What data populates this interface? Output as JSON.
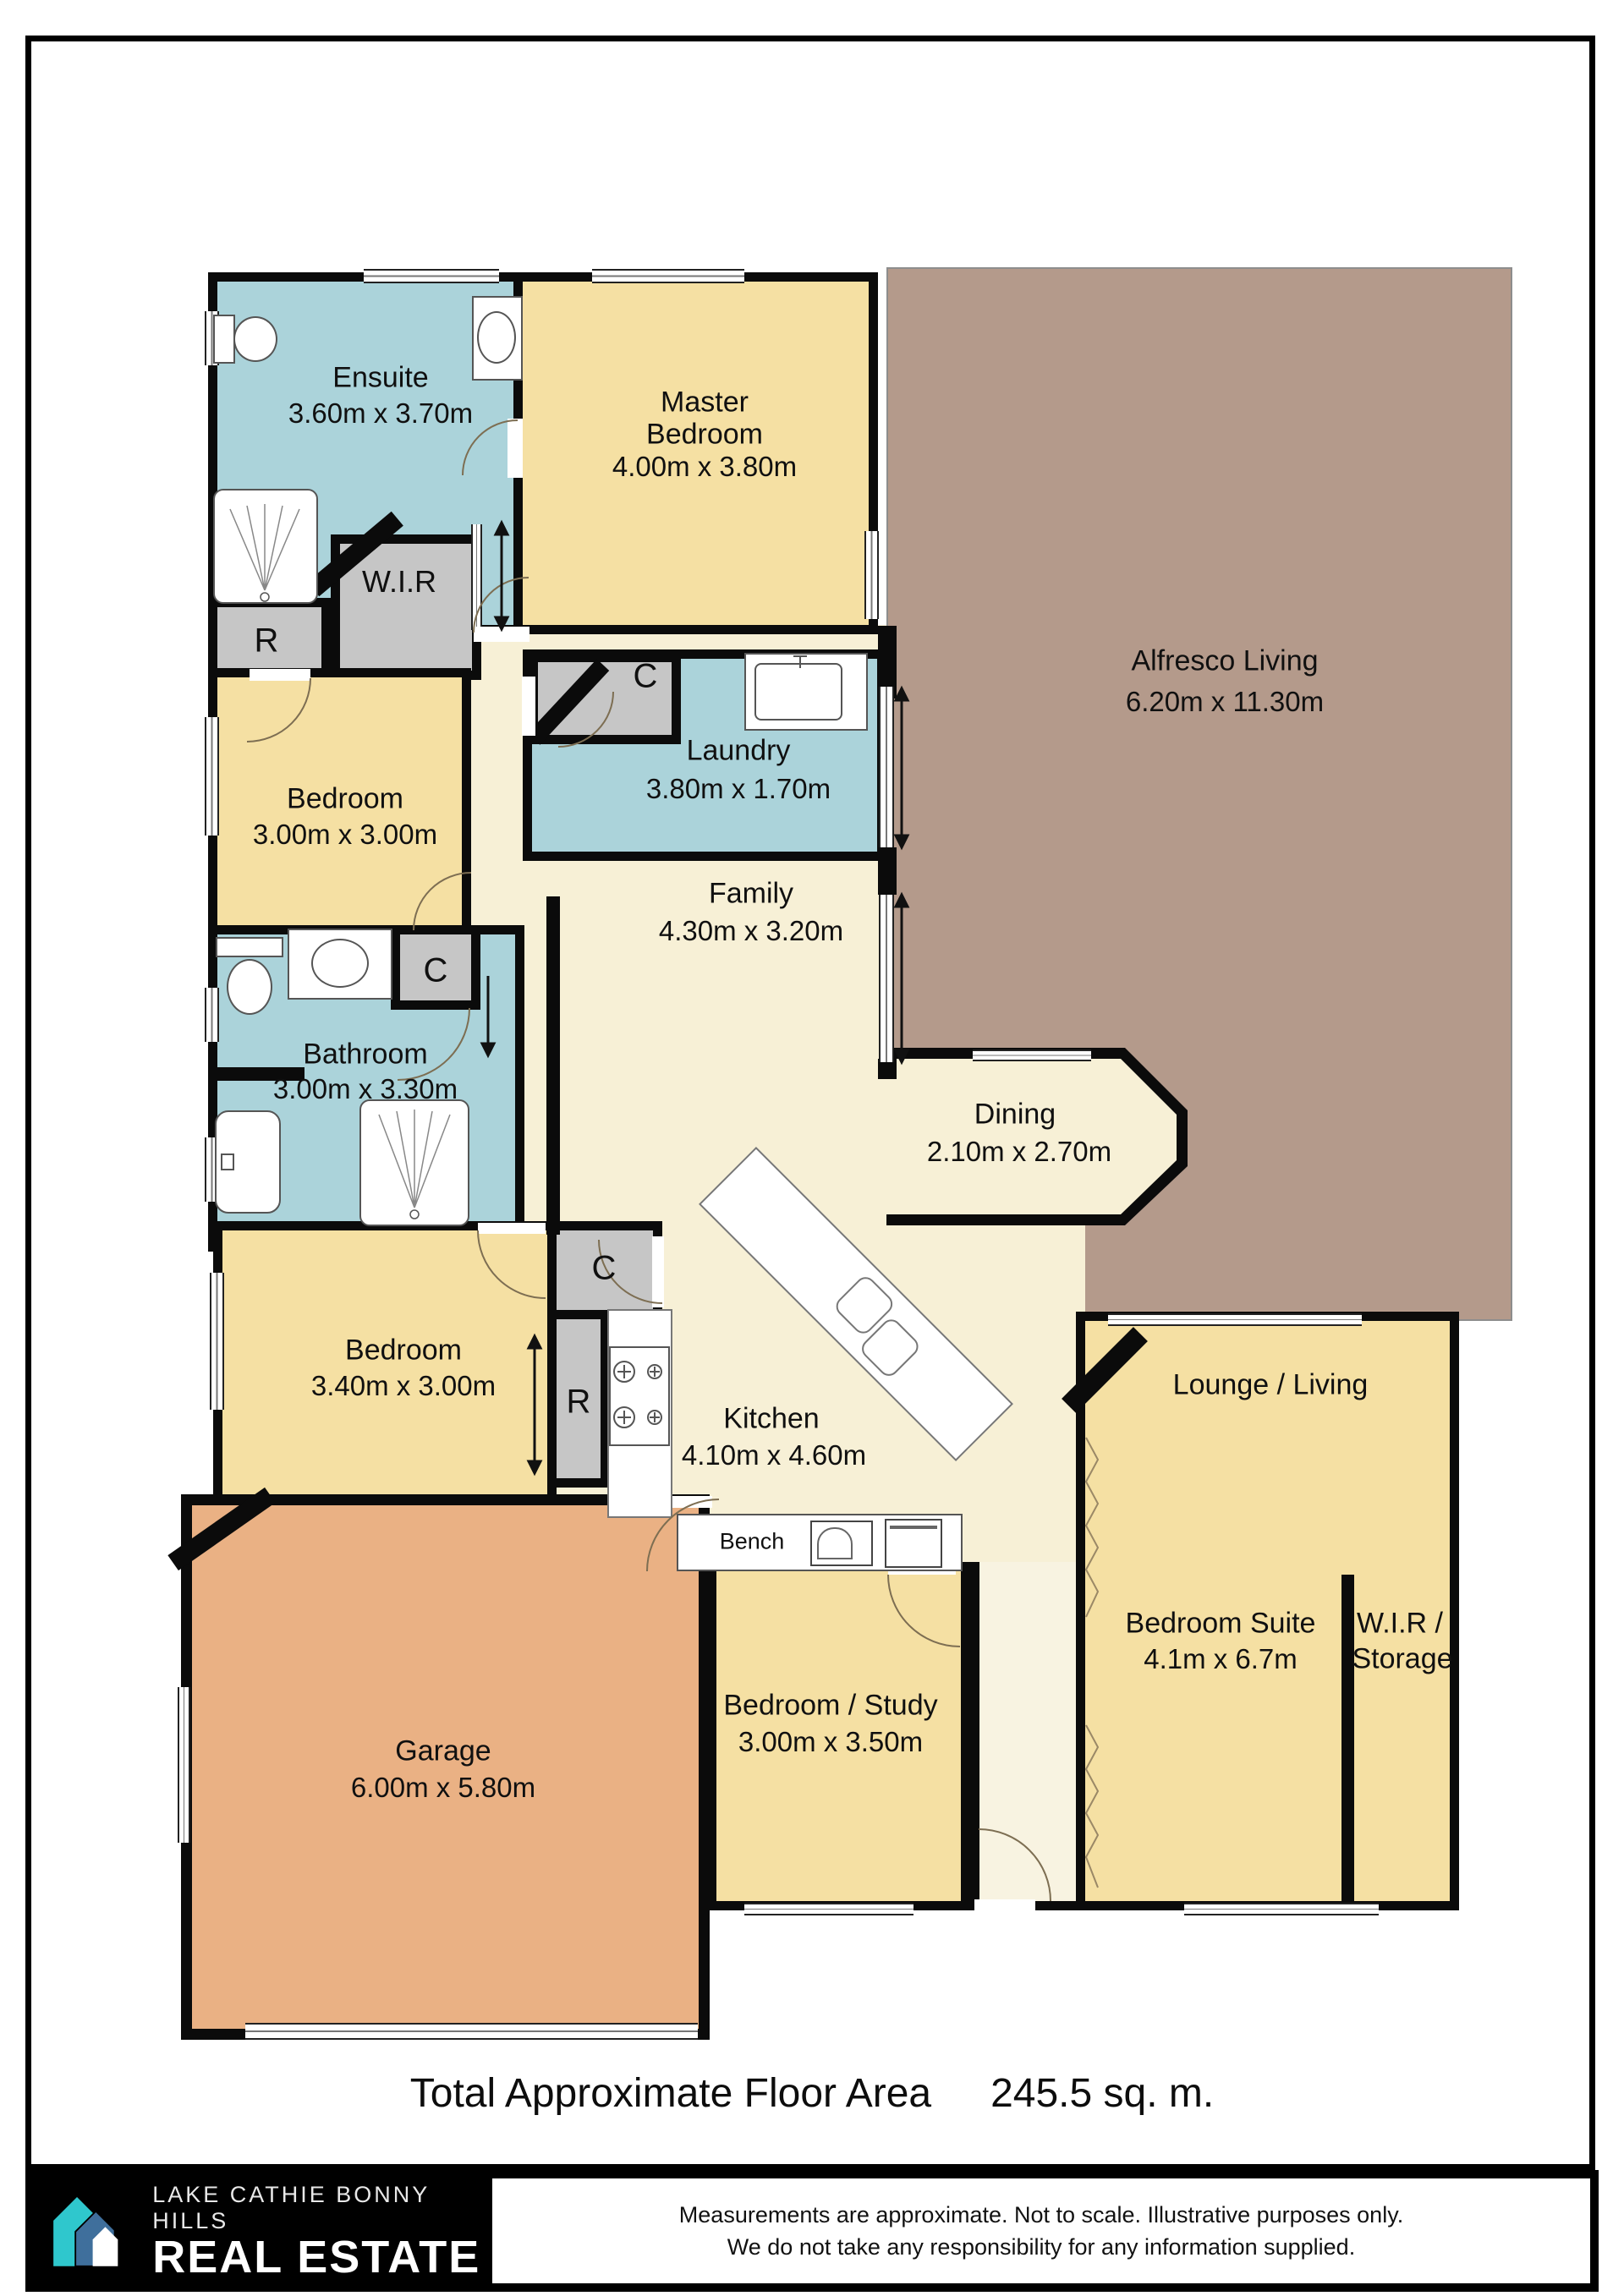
{
  "page": {
    "title_label": "Total Approximate Floor Area",
    "title_value": "245.5 sq. m."
  },
  "rooms": [
    {
      "name": "Ensuite",
      "dims": "3.60m x 3.70m"
    },
    {
      "name": "Master",
      "name2": "Bedroom",
      "dims": "4.00m x 3.80m"
    },
    {
      "name": "Alfresco Living",
      "dims": "6.20m x 11.30m"
    },
    {
      "name": "Laundry",
      "dims": "3.80m x 1.70m"
    },
    {
      "name": "Bedroom",
      "dims": "3.00m x 3.00m"
    },
    {
      "name": "Family",
      "dims": "4.30m x 3.20m"
    },
    {
      "name": "Bathroom",
      "dims": "3.00m x 3.30m"
    },
    {
      "name": "Dining",
      "dims": "2.10m x 2.70m"
    },
    {
      "name": "Bedroom",
      "dims": "3.40m x 3.00m"
    },
    {
      "name": "Kitchen",
      "dims": "4.10m x 4.60m"
    },
    {
      "name": "Lounge / Living"
    },
    {
      "name": "Bedroom Suite",
      "dims": "4.1m x 6.7m"
    },
    {
      "name": "W.I.R /",
      "name2": "Storage"
    },
    {
      "name": "Bedroom / Study",
      "dims": "3.00m x 3.50m"
    },
    {
      "name": "Garage",
      "dims": "6.00m x 5.80m"
    }
  ],
  "markers": {
    "closet": "C",
    "robe": "R",
    "wir": "W.I.R",
    "bench": "Bench"
  },
  "footer": {
    "brand_line1": "LAKE CATHIE BONNY HILLS",
    "brand_line2": "REAL ESTATE",
    "disclaimer_line1": "Measurements are approximate. Not to scale. Illustrative purposes only.",
    "disclaimer_line2": "We do not take any responsibility for any information supplied."
  },
  "colors": {
    "wall": "#0b0b0b",
    "wet_area_blue": "#abd3da",
    "bedroom_yellow": "#f5e0a3",
    "living_cream": "#f7f0d6",
    "alfresco_taupe": "#b49a8b",
    "garage_orange": "#eab184",
    "closet_gray": "#c6c6c6",
    "brand_teal": "#2fc7cd",
    "brand_blue": "#3f6f9c"
  }
}
